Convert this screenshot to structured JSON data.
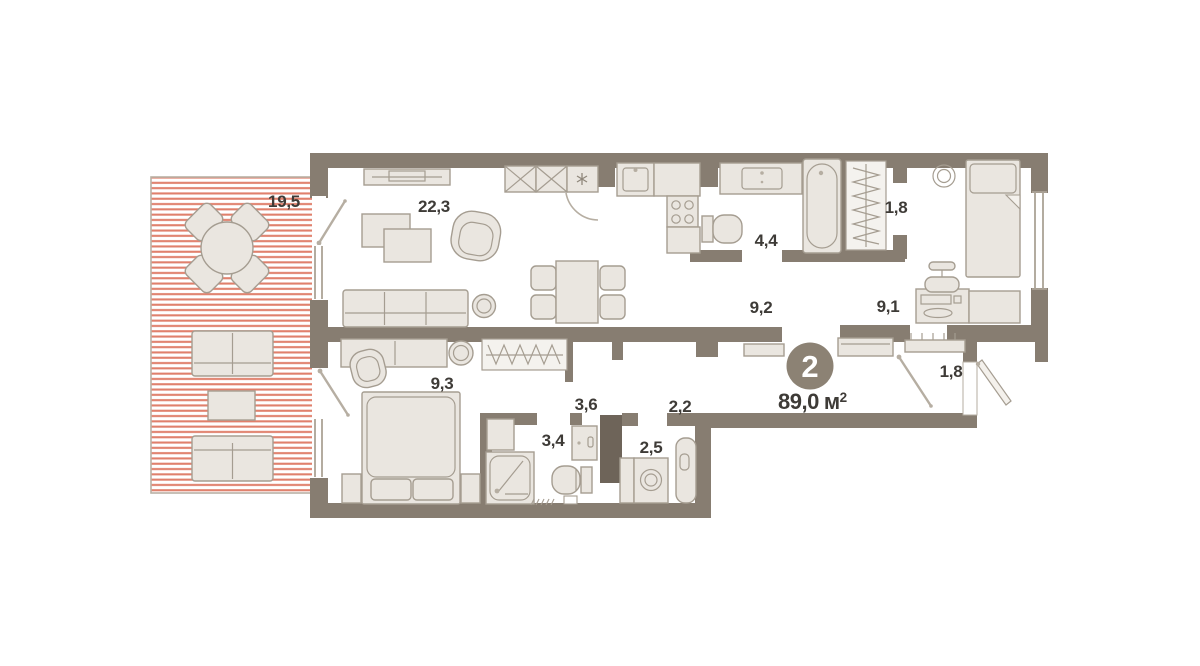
{
  "plan": {
    "summary": {
      "rooms_count": "2",
      "area_value": "89,0",
      "area_unit": "м",
      "area_sup": "2"
    },
    "rooms": [
      {
        "id": "terrace",
        "label": "19,5"
      },
      {
        "id": "living-room",
        "label": "22,3"
      },
      {
        "id": "bathroom",
        "label": "4,4"
      },
      {
        "id": "wardrobe-top",
        "label": "1,8"
      },
      {
        "id": "hallway",
        "label": "9,2"
      },
      {
        "id": "bedroom-right",
        "label": "9,1"
      },
      {
        "id": "entry-hall",
        "label": "1,8"
      },
      {
        "id": "bedroom-left",
        "label": "9,3"
      },
      {
        "id": "corridor-inner",
        "label": "3,6"
      },
      {
        "id": "corridor-link",
        "label": "2,2"
      },
      {
        "id": "shower-room",
        "label": "3,4"
      },
      {
        "id": "laundry",
        "label": "2,5"
      }
    ],
    "colors": {
      "background": "#ffffff",
      "wall": "#877d71",
      "wall_dark": "#6e6459",
      "furniture_fill": "#eae6e0",
      "furniture_stroke": "#a59d91",
      "terrace_stripe": "#e0806c",
      "terrace_border": "#b9b1a5",
      "label_text": "#3e3b37",
      "badge_fill": "#8c8274",
      "badge_text": "#ffffff"
    }
  }
}
